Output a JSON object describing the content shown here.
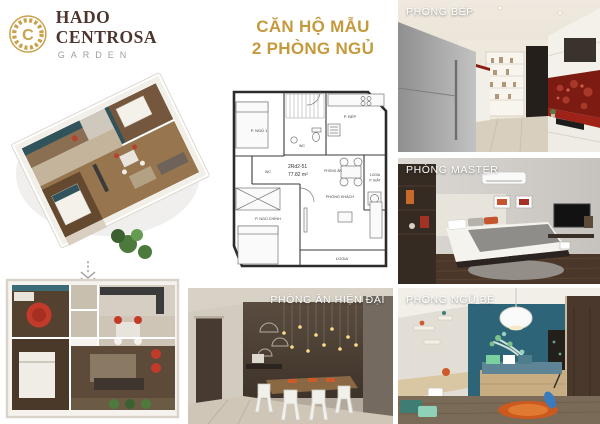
{
  "brand": {
    "name": "HADO CENTROSA",
    "subtitle": "GARDEN",
    "monogram": "C",
    "gold_color": "#c9a24b",
    "name_color": "#4e342e"
  },
  "title": {
    "line1": "CĂN HỘ MẪU",
    "line2": "2 PHÒNG NGỦ",
    "color": "#c49a3c"
  },
  "floor_plan": {
    "unit_code": "2Rd2-51",
    "area": "77.82 m²",
    "labels": {
      "bedroom1": "P. NGỦ 1",
      "wc1": "WC",
      "wc2": "WC",
      "kitchen": "P. BẾP",
      "logia_laundry_line1": "LOGIA",
      "logia_laundry_line2": "P. GIẶT",
      "dining": "PHÒNG ĂN",
      "living": "PHÒNG KHÁCH",
      "master": "P. NGỦ CHÍNH",
      "logia": "LOGIA"
    }
  },
  "photos": {
    "kitchen": {
      "label": "PHÒNG BẾP"
    },
    "master": {
      "label": "PHÒNG MASTER"
    },
    "dining": {
      "label": "PHÒNG ĂN HIỆN ĐẠI"
    },
    "kids": {
      "label": "PHÒNG NGỦ BÉ"
    }
  },
  "palette": {
    "teal_accent": "#2e6478",
    "red_accent": "#c23b2a",
    "wood_dark": "#4a3729",
    "wood_light": "#9c7a55"
  }
}
